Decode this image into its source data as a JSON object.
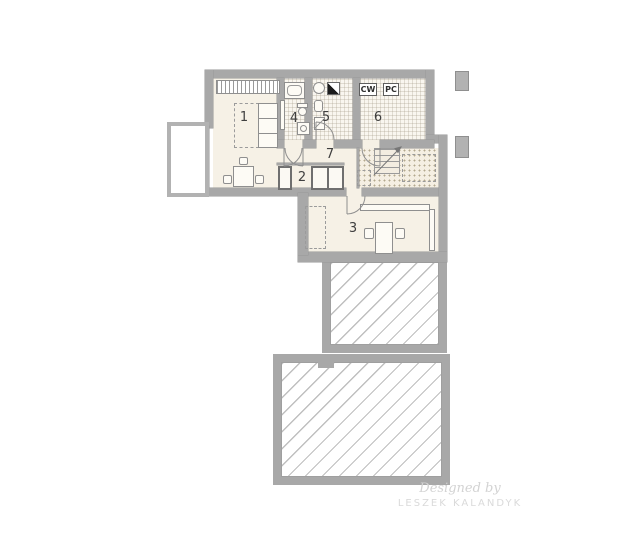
{
  "floor_plan": {
    "room_labels": [
      "1",
      "2",
      "3",
      "4",
      "5",
      "6",
      "7"
    ],
    "equipment_labels": {
      "cw": "CW",
      "pc": "PC"
    },
    "watermark": {
      "designed_by": "Designed by",
      "designer_name": "LESZEK KALANDYK"
    },
    "colors": {
      "wall": "#a8a8a8",
      "floor": "#f6f1e6",
      "tile_floor": "#f9f6ef",
      "hatch_line": "#bfbfbf",
      "background": "#ffffff",
      "label_text": "#3f3f3f"
    }
  }
}
